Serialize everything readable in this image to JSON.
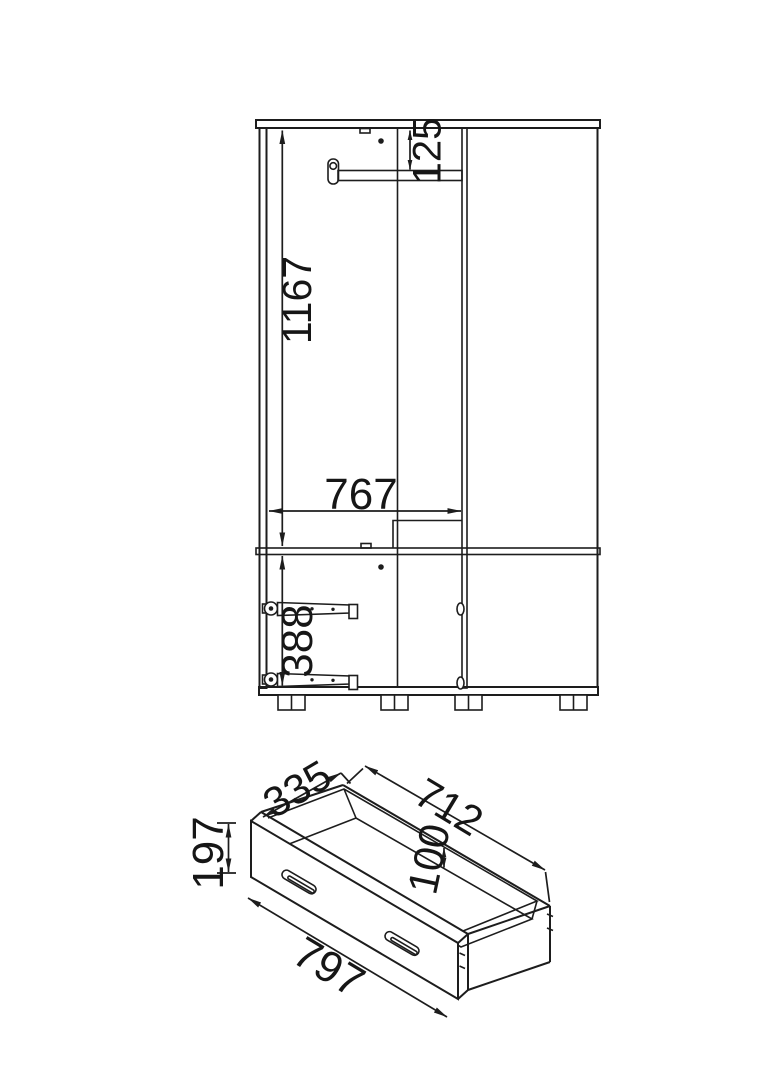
{
  "colors": {
    "line": "#1d1d1d",
    "text": "#161616",
    "background": "#ffffff"
  },
  "wardrobe": {
    "rail_offset": "125",
    "height": "1167",
    "inner_width": "767",
    "drawer_zone_height": "388"
  },
  "drawer": {
    "depth": "335",
    "back_width": "712",
    "front_height": "197",
    "inner_height": "100",
    "front_width": "797"
  }
}
